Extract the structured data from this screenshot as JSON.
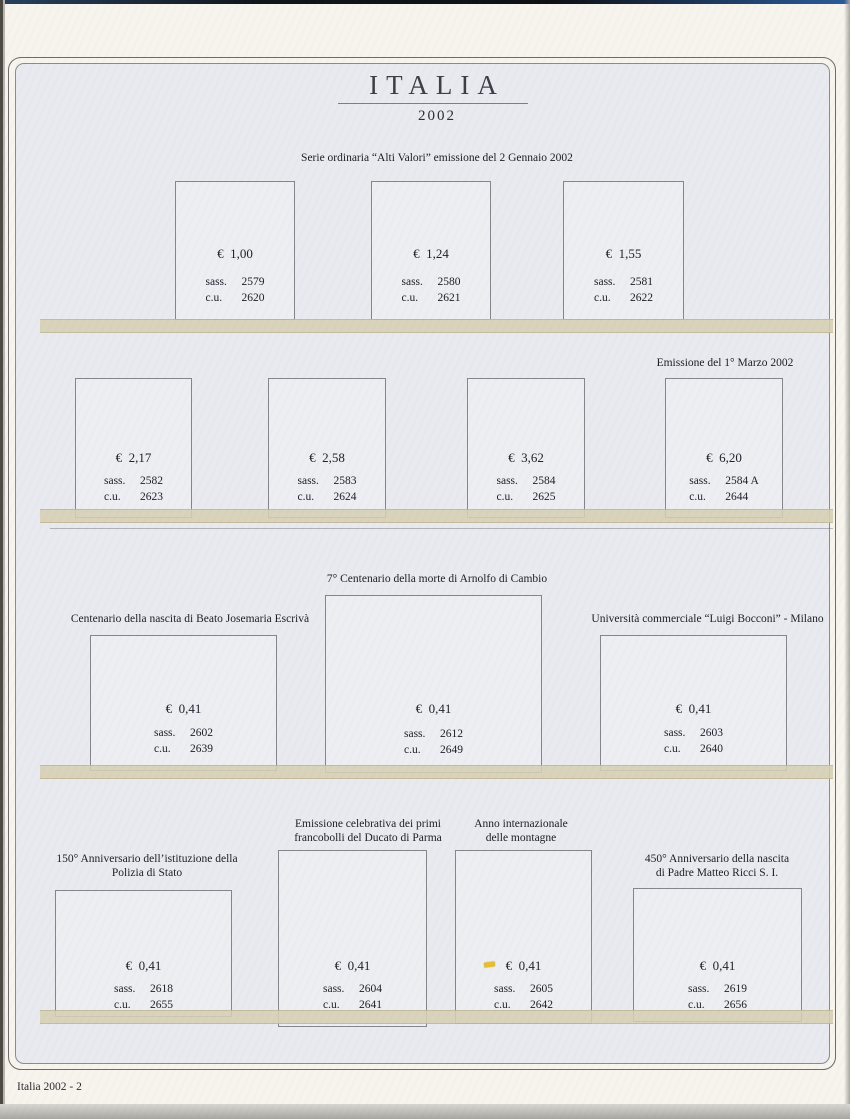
{
  "page": {
    "title": "ITALIA",
    "year": "2002",
    "footer": "Italia 2002 - 2"
  },
  "labels": {
    "sass": "sass.",
    "cu": "c.u."
  },
  "sections": [
    {
      "header": "Serie ordinaria “Alti Valori” emissione del 2 Gennaio 2002",
      "stamps": [
        {
          "value": "€  1,00",
          "sass": "2579",
          "cu": "2620"
        },
        {
          "value": "€  1,24",
          "sass": "2580",
          "cu": "2621"
        },
        {
          "value": "€  1,55",
          "sass": "2581",
          "cu": "2622"
        }
      ]
    },
    {
      "header": "Emissione del 1° Marzo 2002",
      "stamps": [
        {
          "value": "€  2,17",
          "sass": "2582",
          "cu": "2623"
        },
        {
          "value": "€  2,58",
          "sass": "2583",
          "cu": "2624"
        },
        {
          "value": "€  3,62",
          "sass": "2584",
          "cu": "2625"
        },
        {
          "value": "€  6,20",
          "sass": "2584 A",
          "cu": "2644"
        }
      ]
    },
    {
      "stamps": [
        {
          "caption": "Centenario della nascita di Beato Josemaria Escrivà",
          "value": "€  0,41",
          "sass": "2602",
          "cu": "2639"
        },
        {
          "caption": "7° Centenario della morte di Arnolfo di Cambio",
          "value": "€  0,41",
          "sass": "2612",
          "cu": "2649"
        },
        {
          "caption": "Università commerciale “Luigi Bocconi” - Milano",
          "value": "€  0,41",
          "sass": "2603",
          "cu": "2640"
        }
      ]
    },
    {
      "stamps": [
        {
          "caption1": "150° Anniversario dell’istituzione della",
          "caption2": "Polizia di Stato",
          "value": "€  0,41",
          "sass": "2618",
          "cu": "2655"
        },
        {
          "caption1": "Emissione celebrativa dei primi",
          "caption2": "francobolli del Ducato di Parma",
          "value": "€  0,41",
          "sass": "2604",
          "cu": "2641"
        },
        {
          "caption1": "Anno internazionale",
          "caption2": "delle montagne",
          "value": "€  0,41",
          "sass": "2605",
          "cu": "2642"
        },
        {
          "caption1": "450° Anniversario della nascita",
          "caption2": "di Padre Matteo Ricci S. I.",
          "value": "€  0,41",
          "sass": "2619",
          "cu": "2656"
        }
      ]
    }
  ]
}
